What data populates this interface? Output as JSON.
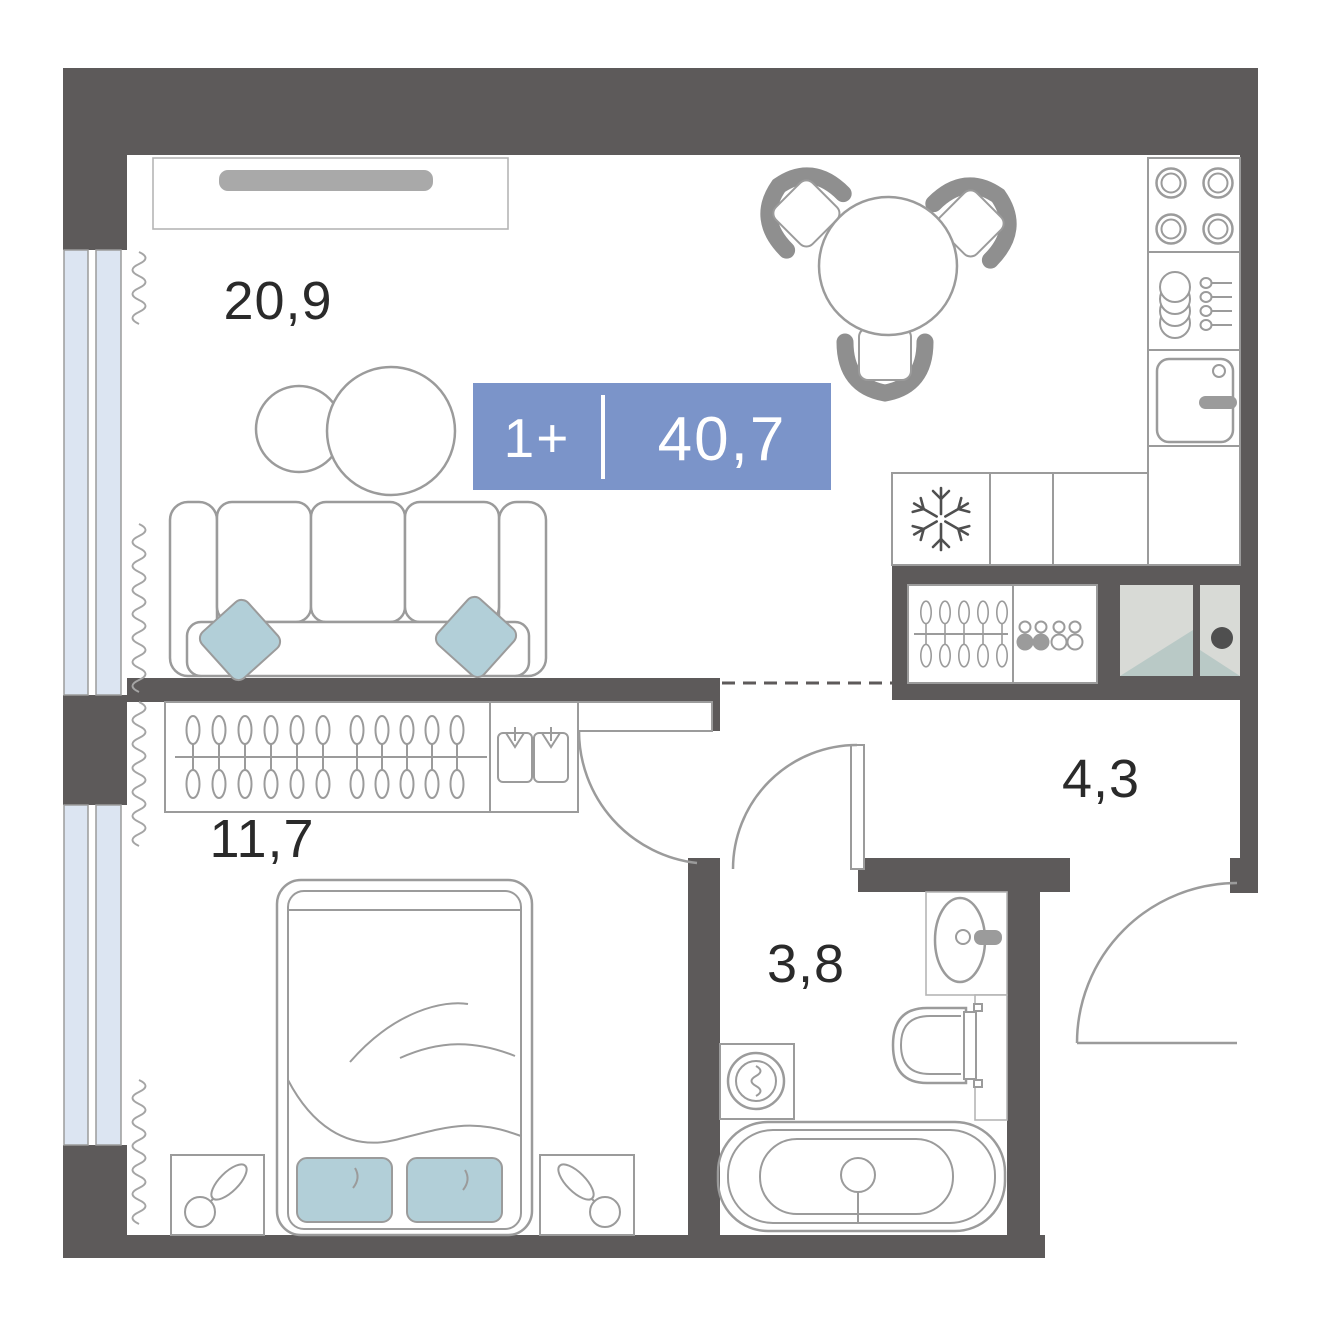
{
  "title": "1-room apartment floor plan",
  "badge": {
    "layout_label": "1+",
    "total_area": "40,7",
    "background_color": "#7b94c9",
    "text_color": "#ffffff"
  },
  "rooms": {
    "living_kitchen": {
      "area": "20,9"
    },
    "bedroom": {
      "area": "11,7"
    },
    "bathroom": {
      "area": "3,8"
    },
    "hallway": {
      "area": "4,3"
    }
  },
  "colors": {
    "wall": "#5d5a5a",
    "furniture_outline": "#9b9b9b",
    "window_glass": "#dce5f2",
    "pillow_teal": "#b2cfd8",
    "tv_gray": "#a9a9a9",
    "chair_gray": "#8f8f8f",
    "shaft_panel": "#d8dad6",
    "shaft_panel_shade": "#b9c9c6",
    "label_text": "#2a2a2a"
  },
  "icons": {
    "refrigerator": "snowflake-icon",
    "wardrobe": "hanger-icon",
    "shoe_shelf": "shoes-icon",
    "closet": "shirt-icon",
    "nightstand_decor": "plant-icon",
    "washing_machine": "drum-squiggle-icon"
  }
}
